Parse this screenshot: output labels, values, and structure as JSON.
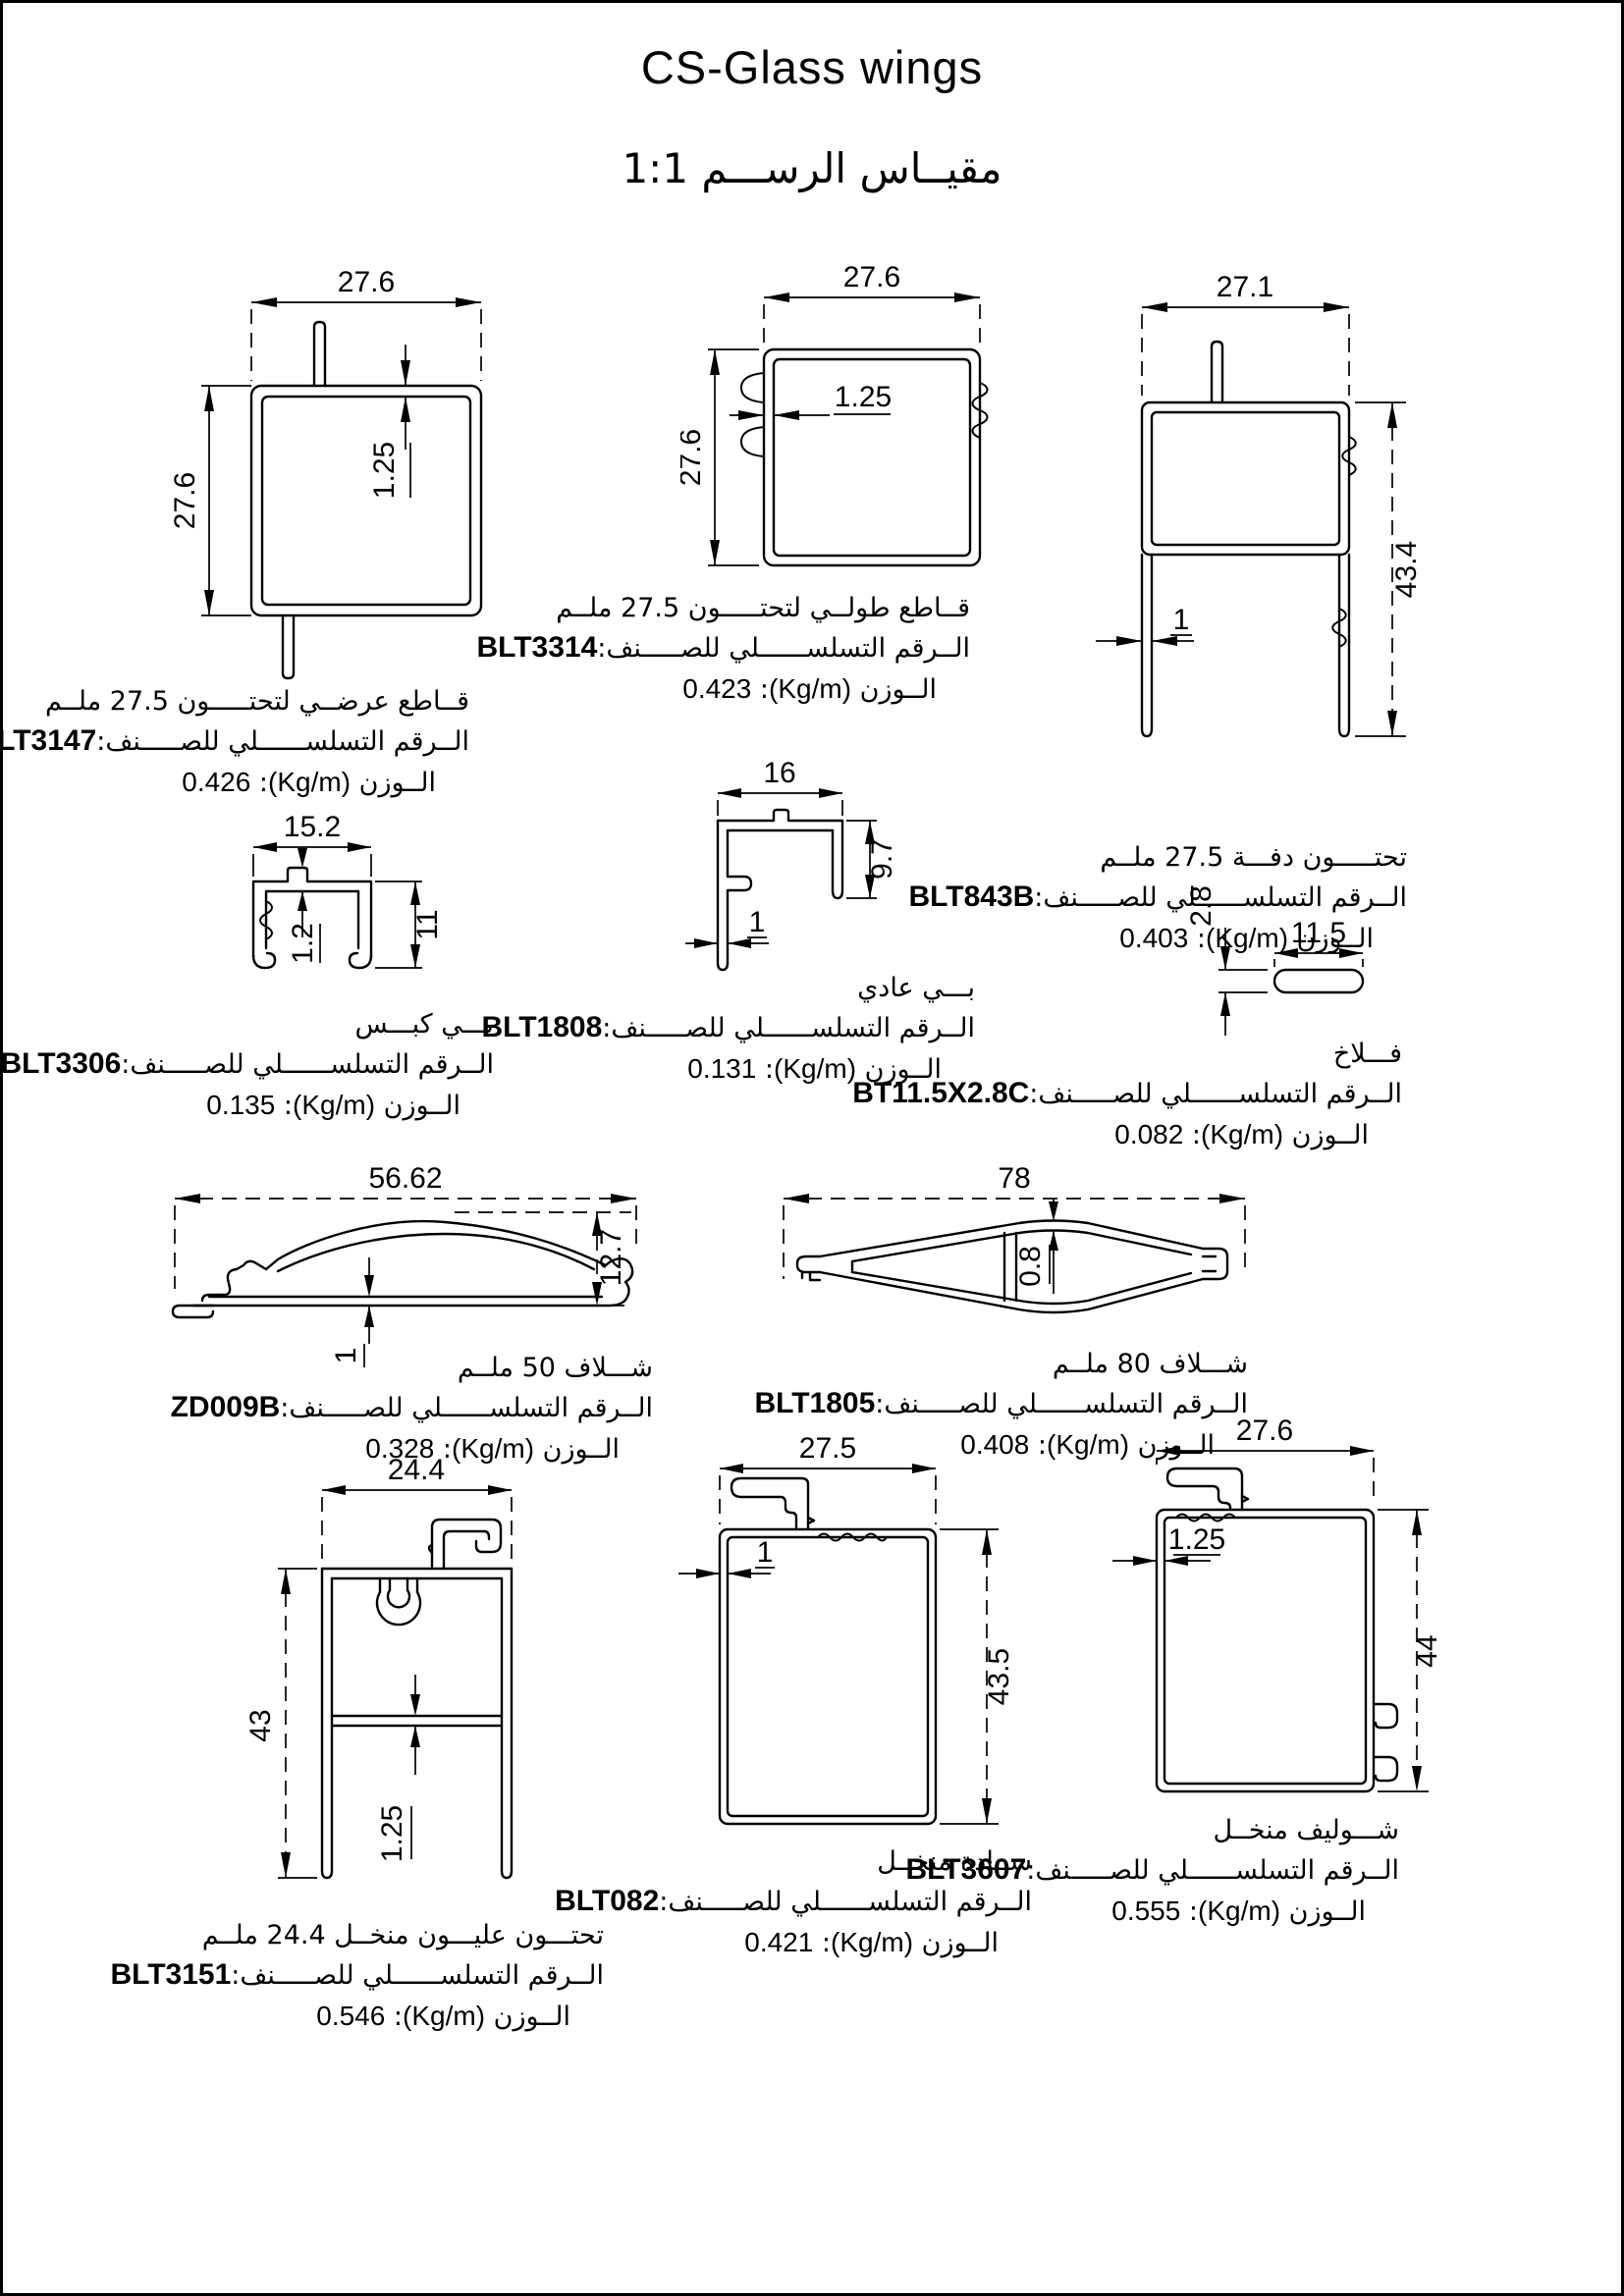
{
  "page": {
    "title": "CS-Glass wings",
    "subtitle": "مقيــاس الرســـم 1:1"
  },
  "labels": {
    "serial_prefix": "الــرقم التسلســــــلي للصـــــنف:",
    "weight_label": "الــوزن",
    "weight_unit": "(Kg/m)",
    "colon": ":"
  },
  "profiles": [
    {
      "code": "BLT3147",
      "desc": "قــاطع عرضــي لتحتـــــون 27.5 ملــم",
      "weight": "0.426",
      "dims": {
        "width": "27.6",
        "height": "27.6",
        "wall": "1.25"
      }
    },
    {
      "code": "BLT3314",
      "desc": "قــاطع طولــي لتحتـــــون 27.5 ملــم",
      "weight": "0.423",
      "dims": {
        "width": "27.6",
        "height": "27.6",
        "wall": "1.25"
      }
    },
    {
      "code": "BLT843B",
      "desc": "تحتـــــون دفـــة 27.5 ملــم",
      "weight": "0.403",
      "dims": {
        "width": "27.1",
        "height": "43.4",
        "wall": "1"
      }
    },
    {
      "code": "BLT3306",
      "desc": "بـــي كبـــس",
      "weight": "0.135",
      "dims": {
        "width": "15.2",
        "height": "11",
        "wall": "1.2"
      }
    },
    {
      "code": "BLT1808",
      "desc": "بـــي عادي",
      "weight": "0.131",
      "dims": {
        "width": "16",
        "height": "9.7",
        "wall": "1"
      }
    },
    {
      "code": "BT11.5X2.8C",
      "desc": "فـــلاخ",
      "weight": "0.082",
      "dims": {
        "width": "11.5",
        "height": "2.8"
      }
    },
    {
      "code": "ZD009B",
      "desc": "شـــلاف 50 ملــم",
      "weight": "0.328",
      "dims": {
        "width": "56.62",
        "height": "12.7",
        "wall": "1"
      }
    },
    {
      "code": "BLT1805",
      "desc": "شـــلاف 80 ملــم",
      "weight": "0.408",
      "dims": {
        "width": "78",
        "wall": "0.8"
      }
    },
    {
      "code": "BLT3151",
      "desc": "تحتـــون عليـــون منخــل 24.4 ملــم",
      "weight": "0.546",
      "dims": {
        "width": "24.4",
        "height": "43",
        "wall": "1.25"
      }
    },
    {
      "code": "BLT082",
      "desc": "ســادة منخــل",
      "weight": "0.421",
      "dims": {
        "width": "27.5",
        "height": "43.5",
        "wall": "1"
      }
    },
    {
      "code": "BLT3607",
      "desc": "شـــوليف منخــل",
      "weight": "0.555",
      "dims": {
        "width": "27.6",
        "height": "44",
        "wall": "1.25"
      }
    }
  ]
}
